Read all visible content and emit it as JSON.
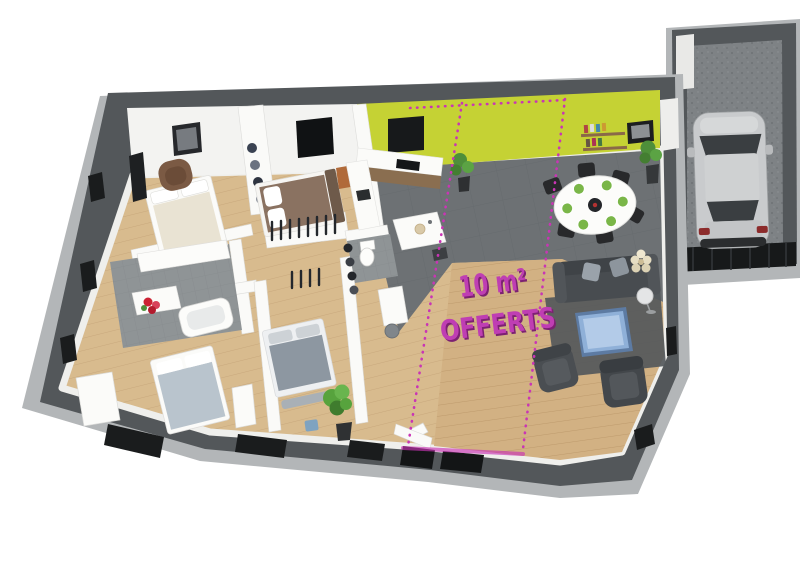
{
  "scene": {
    "type": "3d-floor-plan-render",
    "annotation": {
      "line1": "10 m²",
      "line2": "OFFERTS",
      "color": "#bf3eb3",
      "shadow_color": "#7c2172"
    },
    "offer_zone": {
      "boundary_style": "dashed",
      "boundary_color": "#c935b5"
    },
    "palette": {
      "background": "#ffffff",
      "wall_dark": "#53575a",
      "wall_rim_light": "#b3b6b8",
      "interior_wall": "#f2f2f0",
      "accent_wall_green": "#c5d234",
      "floor_wood_bedrooms": "#d8bb8e",
      "floor_wood_living": "#d2b183",
      "floor_tile_kitchen": "#6d7174",
      "floor_tile_bathroom": "#8f9496",
      "garage_floor": "#7e8285",
      "garage_door": "#17191a",
      "car_silver": "#c9cbcd",
      "car_glass": "#3a3e41",
      "sofa_gray": "#484c50",
      "coffee_table_blue": "#8fb0d8",
      "bed_cream": "#e9e3d3",
      "bed_brown": "#8a7261",
      "bed_gray_blue": "#b9c4cd",
      "bed_gray": "#8d97a1",
      "armchair_brown": "#7b5a44",
      "dining_chair_black": "#28292b",
      "plate_green": "#7ab648",
      "plant_green": "#4e8f3a",
      "flower_red": "#cc2233",
      "counter_wood": "#8a6e50",
      "window_black": "#1a1c1d"
    }
  }
}
